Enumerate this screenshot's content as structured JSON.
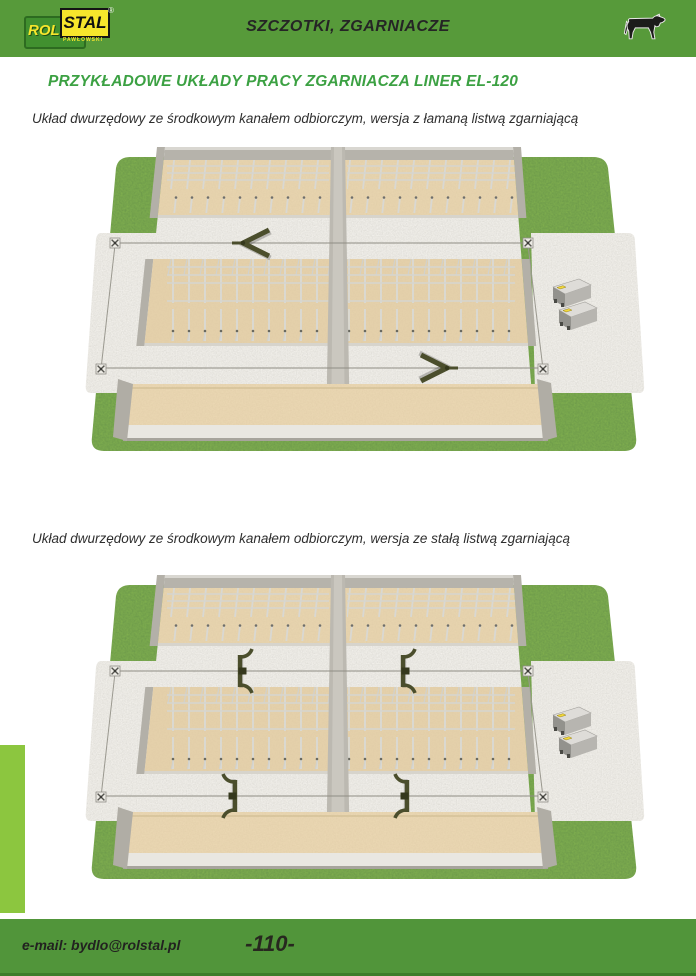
{
  "header": {
    "title": "SZCZOTKI, ZGARNIACZE",
    "logo": {
      "rol": "ROL",
      "stal": "STAL",
      "sub": "PAWŁOWSKI",
      "reg": "®"
    },
    "cow_icon": "cow-silhouette",
    "bg_color": "#579a3a"
  },
  "content": {
    "heading": "PRZYKŁADOWE UKŁADY PRACY ZGARNIACZA LINER EL-120",
    "heading_color": "#3ca143",
    "sections": [
      {
        "caption": "Układ dwurzędowy ze środkowym kanałem odbiorczym, wersja z łamaną listwą  zgarniającą",
        "illustration": "isometric barn plan: grass, concrete aprons with corner pulleys, two bedding rows with freestall dividers, two scraper alleys, central receiving channel, front cross lane, two drive units, two V-shaped (articulated) scrapers — one pointing left in upper alley, one pointing right in lower alley"
      },
      {
        "caption": "Układ dwurzędowy ze środkowym kanałem odbiorczym, wersja ze stałą listwą  zgarniającą",
        "illustration": "same barn plan with four fixed-blade scrapers, one per alley half"
      }
    ]
  },
  "footer": {
    "email": "e-mail: bydlo@rolstal.pl",
    "page_number": "-110-",
    "bg_color": "#51953a",
    "side_tab_color": "#8cc63f"
  },
  "colors": {
    "grass": "#7fae4e",
    "concrete_light": "#f3f1ec",
    "bedding_tan": "#e9d6b0",
    "wall_gray": "#b3b0a8",
    "scraper_olive": "#4b4e2c",
    "logo_yellow": "#f7e62c",
    "logo_green": "#41902f"
  }
}
